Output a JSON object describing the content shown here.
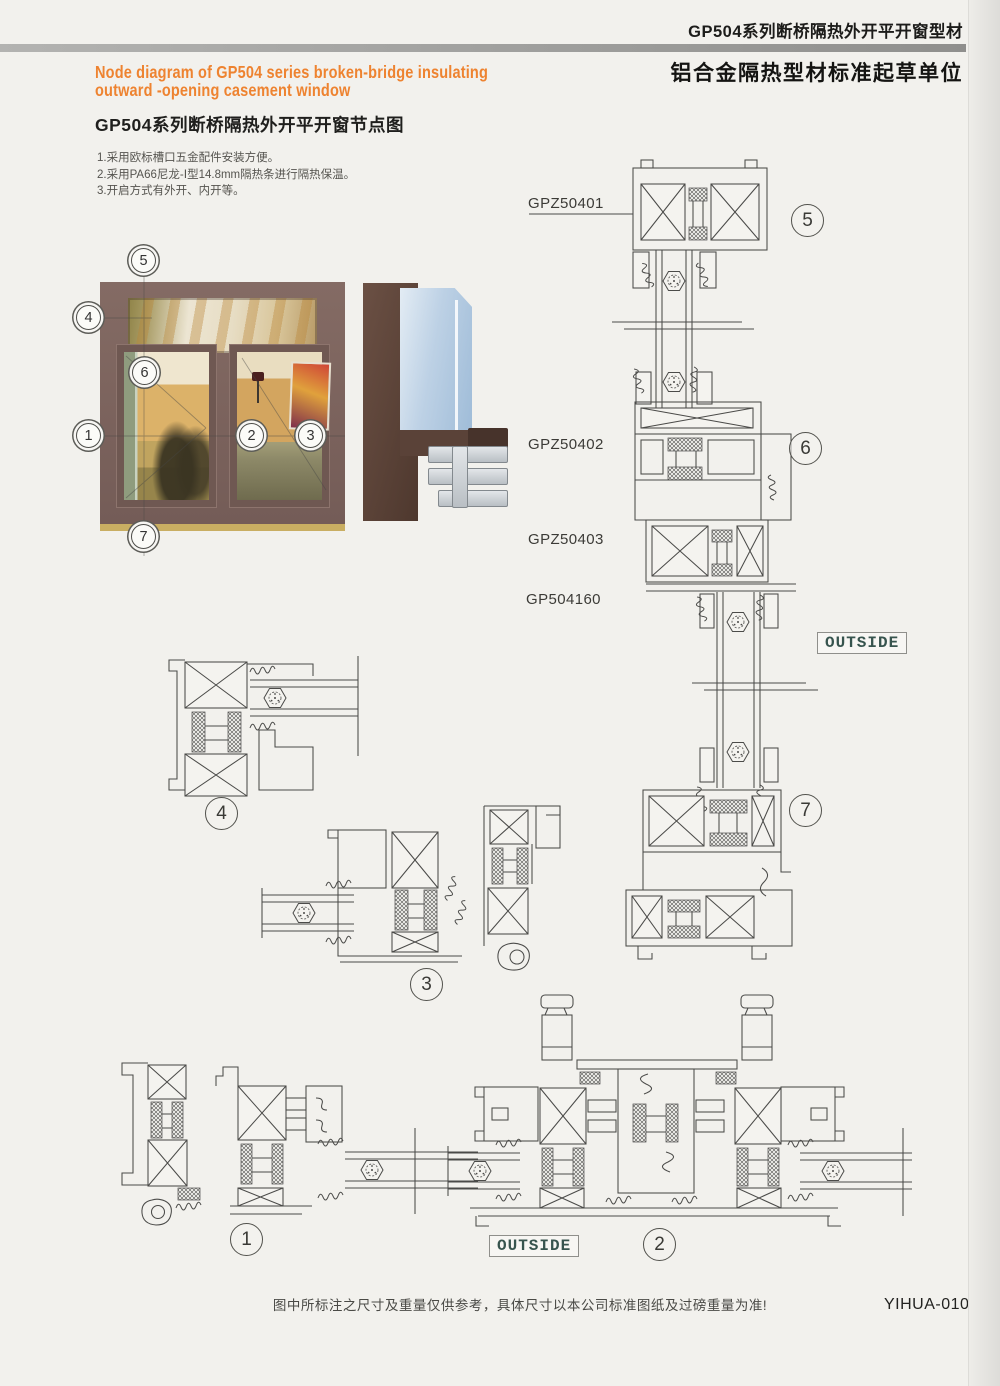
{
  "header": {
    "product_line": "GP504系列断桥隔热外开平开窗型材",
    "org_line": "铝合金隔热型材标准起草单位"
  },
  "title_block": {
    "en_line1": "Node diagram of GP504 series broken-bridge insulating",
    "en_line2": "outward -opening casement window",
    "cn_title": "GP504系列断桥隔热外开平开窗节点图"
  },
  "notes": {
    "n1": "1.采用欧标槽口五金配件安装方便。",
    "n2": "2.采用PA66尼龙-Ⅰ型14.8mm隔热条进行隔热保温。",
    "n3": "3.开启方式有外开、内开等。"
  },
  "profile_labels": {
    "l1": "GPZ50401",
    "l2": "GPZ50402",
    "l3": "GPZ50403",
    "l4": "GP504160"
  },
  "outside_label": "OUTSIDE",
  "callouts": {
    "c1": "1",
    "c2": "2",
    "c3": "3",
    "c4": "4",
    "c5": "5",
    "c6": "6",
    "c7": "7"
  },
  "footer": {
    "disclaimer": "图中所标注之尺寸及重量仅供参考，具体尺寸以本公司标准图纸及过磅重量为准!",
    "page_code": "YIHUA-010"
  },
  "colors": {
    "accent_orange": "#ee8330",
    "paper": "#f2f1ed",
    "drawing_line": "#4b4b49",
    "outside_text": "#37544e",
    "window_frame_brown": "#7b625c"
  }
}
